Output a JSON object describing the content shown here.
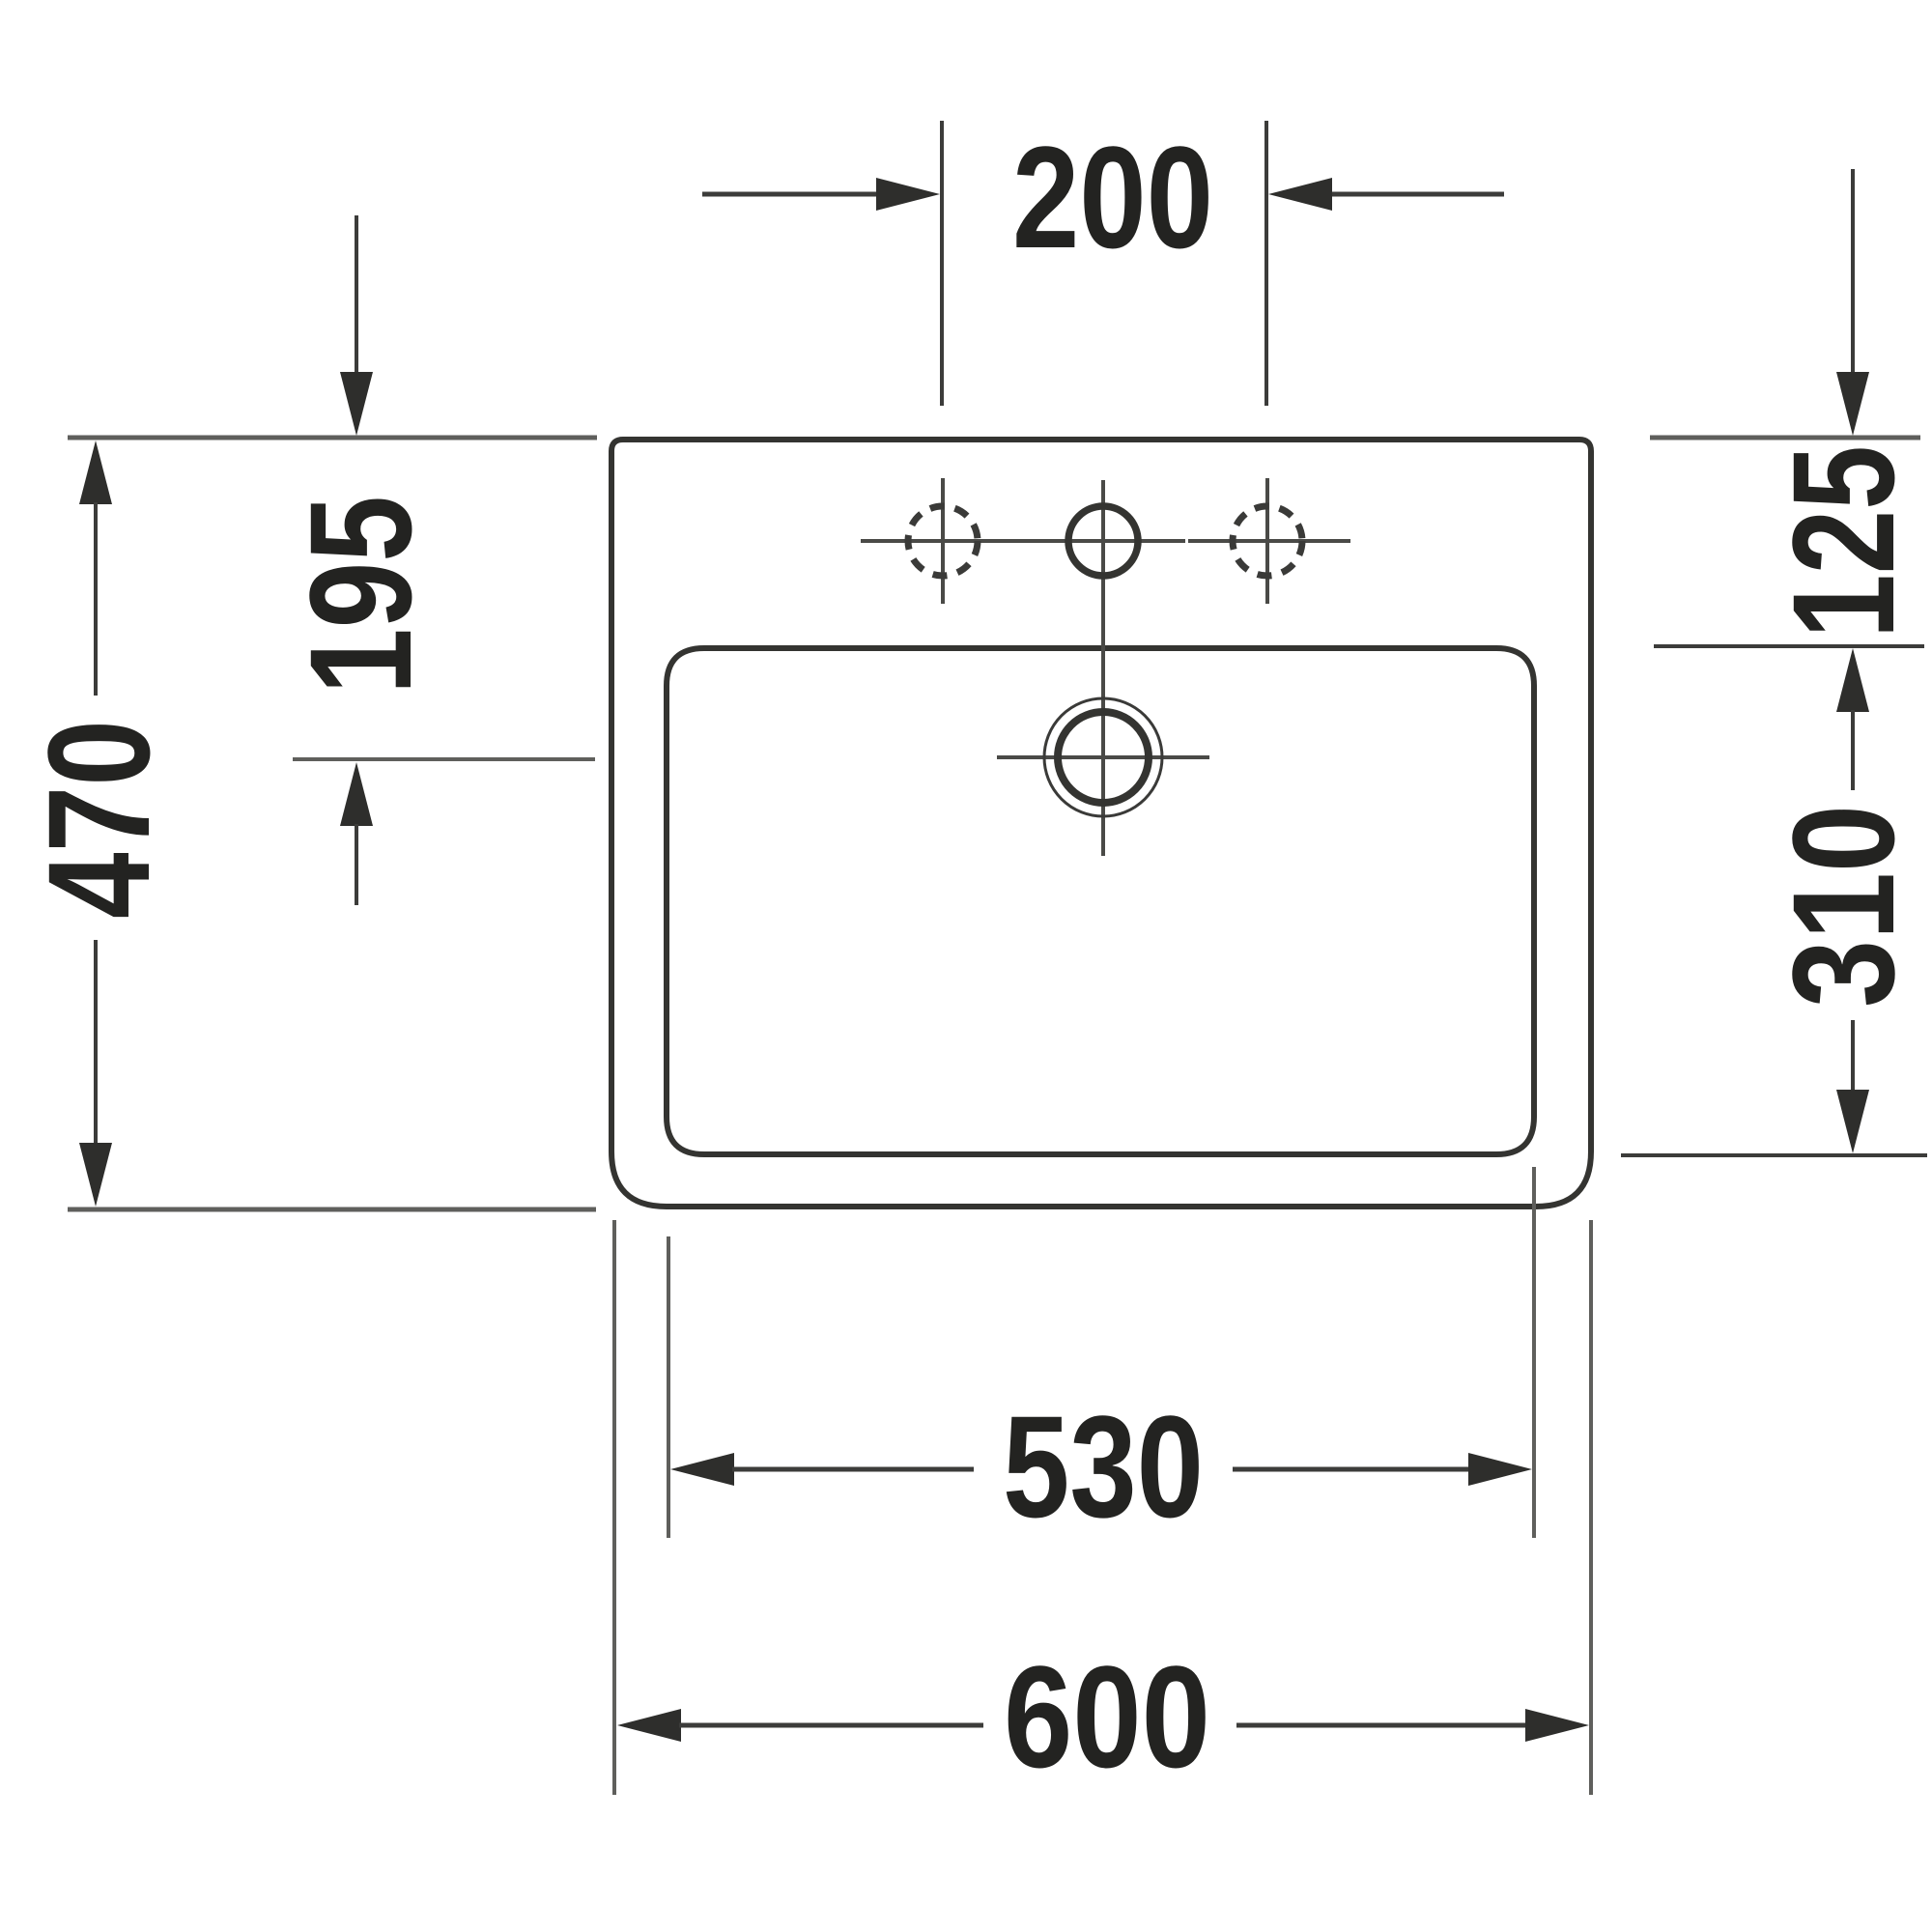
{
  "drawing": {
    "type": "technical-dimension-drawing",
    "subject": "rectangular washbasin, top view, with three tap holes and overflow",
    "unit": "mm",
    "labels": {
      "hole_spacing": "200",
      "rim_to_overflow": "195",
      "overall_depth": "470",
      "rim_to_bowl": "125",
      "bowl_depth": "310",
      "bowl_width": "530",
      "overall_width": "600"
    },
    "colors": {
      "background": "#ffffff",
      "outline": "#343431",
      "dimension_line": "#3c3c3a",
      "extension_line": "#5f5f5c",
      "centerline": "#4a4a47",
      "arrow_fill": "#2e2e2c",
      "text": "#232321"
    }
  }
}
